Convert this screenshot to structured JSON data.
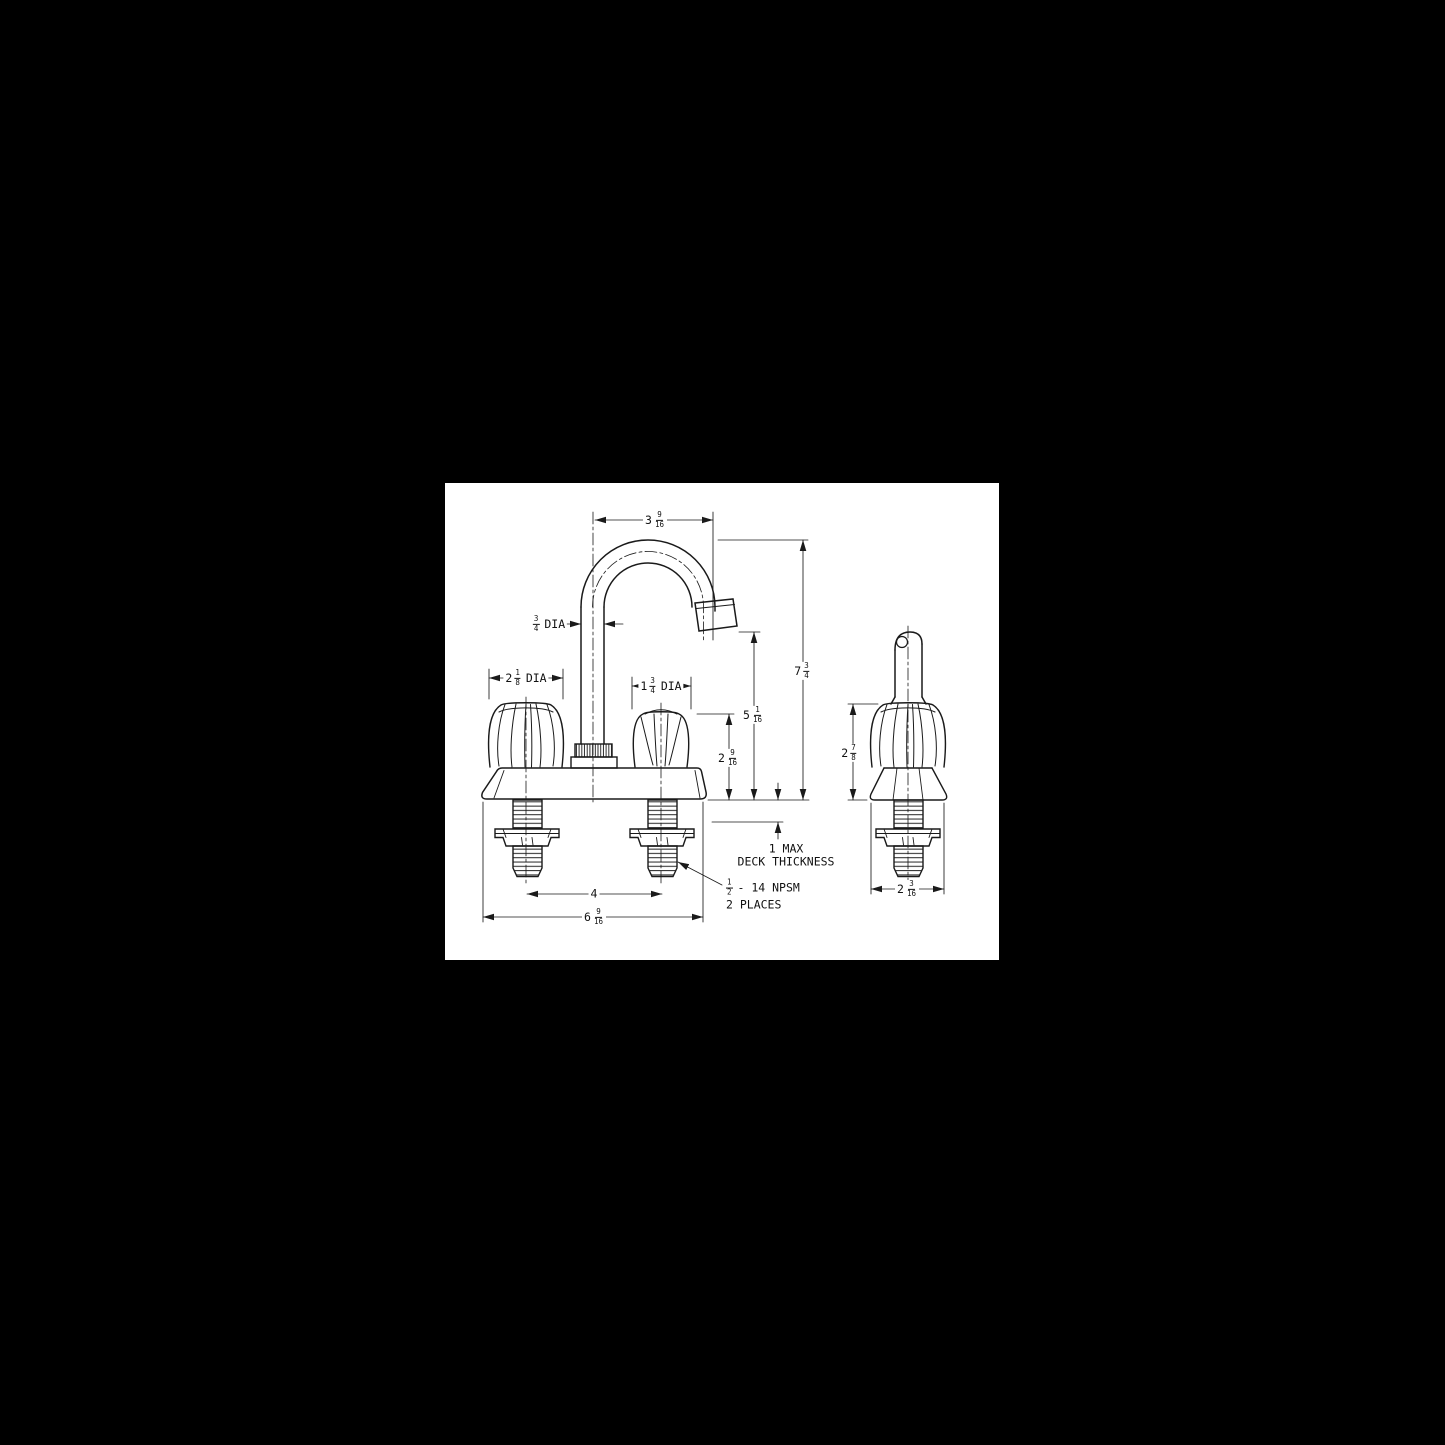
{
  "drawing": {
    "type": "technical-dimension-drawing",
    "subject": "two-handle deck-mount gooseneck faucet, front view and side view",
    "paper_color": "#ffffff",
    "background_color": "#000000",
    "line_color": "#1a1a1a"
  },
  "labels": {
    "spout_span": {
      "whole": "3",
      "num": "9",
      "den": "16"
    },
    "spout_dia": {
      "num": "3",
      "den": "4",
      "suffix": "DIA"
    },
    "left_handle_dia": {
      "whole": "2",
      "num": "1",
      "den": "8",
      "suffix": "DIA"
    },
    "right_handle_dia": {
      "whole": "1",
      "num": "3",
      "den": "4",
      "suffix": "DIA"
    },
    "overall_height": {
      "whole": "7",
      "num": "3",
      "den": "4"
    },
    "spout_outlet_height": {
      "whole": "5",
      "num": "1",
      "den": "16"
    },
    "handle_height": {
      "whole": "2",
      "num": "9",
      "den": "16"
    },
    "deck_thickness": {
      "line1": "1 MAX",
      "line2": "DECK THICKNESS"
    },
    "shank_thread": {
      "num": "1",
      "den": "2",
      "suffix": "- 14 NPSM",
      "line2": "2 PLACES"
    },
    "center_spacing": {
      "whole": "4"
    },
    "overall_width": {
      "whole": "6",
      "num": "9",
      "den": "16"
    },
    "side_handle_height": {
      "whole": "2",
      "num": "7",
      "den": "8"
    },
    "side_base_width": {
      "whole": "2",
      "num": "3",
      "den": "16"
    }
  }
}
